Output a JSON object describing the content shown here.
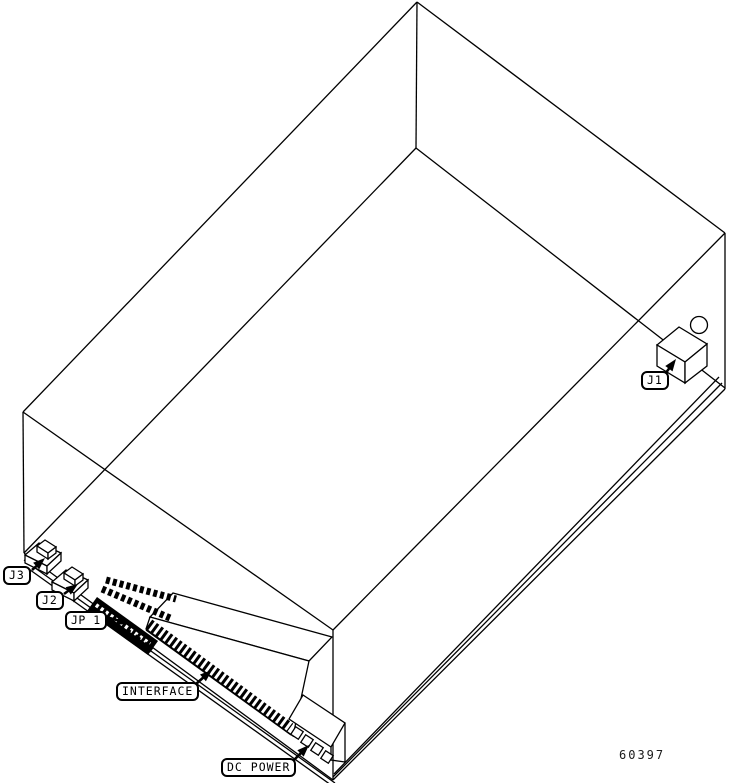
{
  "diagram": {
    "figure_number": "60397",
    "ink_color": "#000000",
    "background_color": "#ffffff",
    "callouts": {
      "j1": "J1",
      "j3": "J3",
      "j2": "J2",
      "jp1": "JP 1",
      "interface": "INTERFACE",
      "dc_power": "DC POWER"
    }
  }
}
